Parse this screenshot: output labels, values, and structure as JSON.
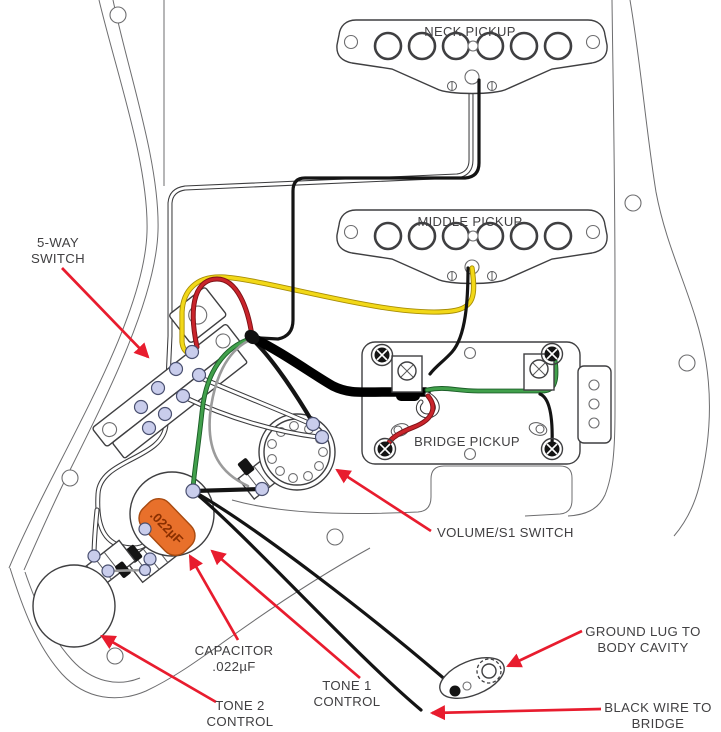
{
  "diagram": {
    "type": "guitar-wiring-diagram",
    "labels": {
      "neck_pickup": "NECK PICKUP",
      "middle_pickup": "MIDDLE PICKUP",
      "bridge_pickup": "BRIDGE PICKUP",
      "five_way_1": "5-WAY",
      "five_way_2": "SWITCH",
      "volume_s1": "VOLUME/S1 SWITCH",
      "capacitor_1": "CAPACITOR",
      "capacitor_2": ".022µF",
      "tone1_1": "TONE 1",
      "tone1_2": "CONTROL",
      "tone2_1": "TONE 2",
      "tone2_2": "CONTROL",
      "ground_1": "GROUND LUG TO",
      "ground_2": "BODY CAVITY",
      "bridge_wire_1": "BLACK WIRE TO",
      "bridge_wire_2": "BRIDGE",
      "capacitor_body": ".022µF"
    },
    "colors": {
      "callout_arrow": "#e81c2e",
      "label_text": "#414042",
      "wire_yellow": "#f2d818",
      "wire_red": "#c9242b",
      "wire_green": "#41a04b",
      "wire_black": "#141414",
      "wire_white": "#ffffff",
      "wire_gray": "#9b9b9b",
      "capacitor_fill": "#e8702b",
      "solder_lug_fill": "#c9cdec",
      "outline": "#6d6d6f"
    }
  }
}
